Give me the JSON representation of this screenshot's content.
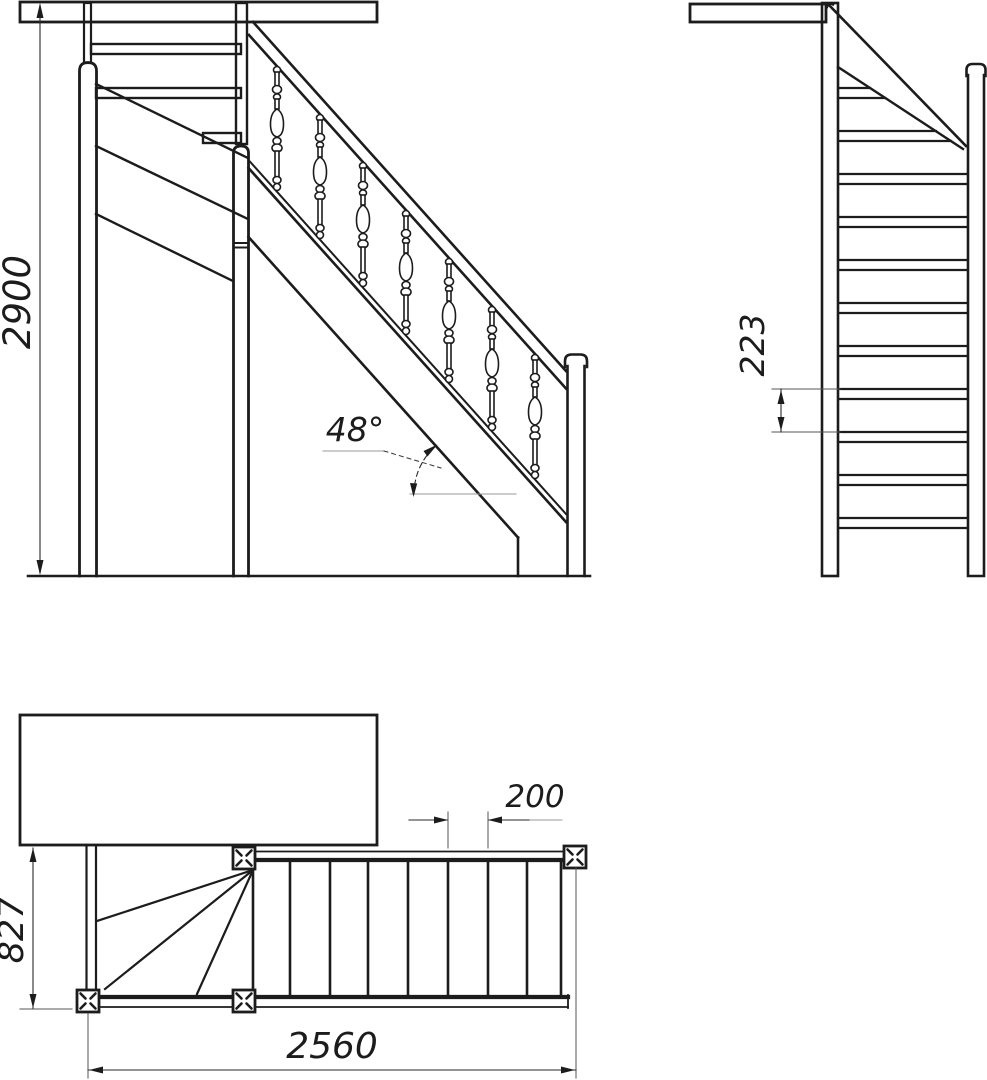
{
  "drawing": {
    "background": "#ffffff",
    "line_color": "#1c1c1c",
    "dimension_labels": {
      "total_height": "2900",
      "angle": "48°",
      "riser_height": "223",
      "tread_depth": "200",
      "stair_width": "827",
      "total_run": "2560"
    }
  }
}
